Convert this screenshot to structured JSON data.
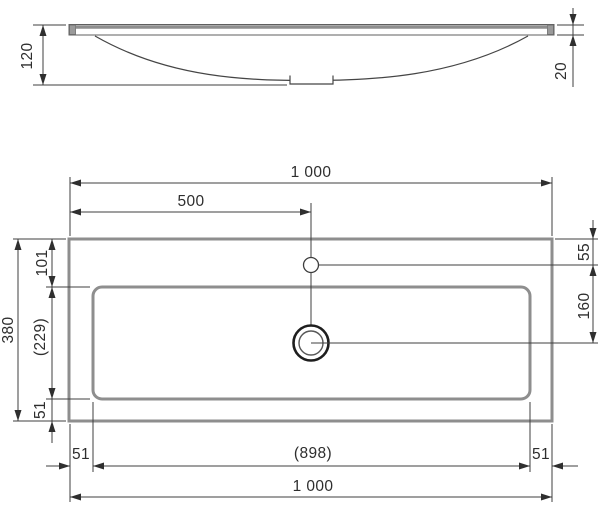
{
  "colors": {
    "background": "#ffffff",
    "thick_outline_gray": "#8e8e8e",
    "thin_line": "#3f3f3f",
    "drain_outline": "#1e1e1e",
    "text": "#2e2e2e"
  },
  "front_view": {
    "dims": {
      "basin_height": "120",
      "rim_thickness": "20"
    }
  },
  "plan_view": {
    "dims": {
      "overall_width_top": "1 000",
      "faucet_center_from_left": "500",
      "overall_depth": "380",
      "rim_to_bowl_top": "101",
      "bowl_depth": "(229)",
      "bowl_to_front_edge": "51",
      "top_edge_to_faucet": "55",
      "faucet_to_drain": "160",
      "left_rim": "51",
      "bowl_width": "(898)",
      "right_rim": "51",
      "overall_width_bottom": "1 000"
    }
  }
}
